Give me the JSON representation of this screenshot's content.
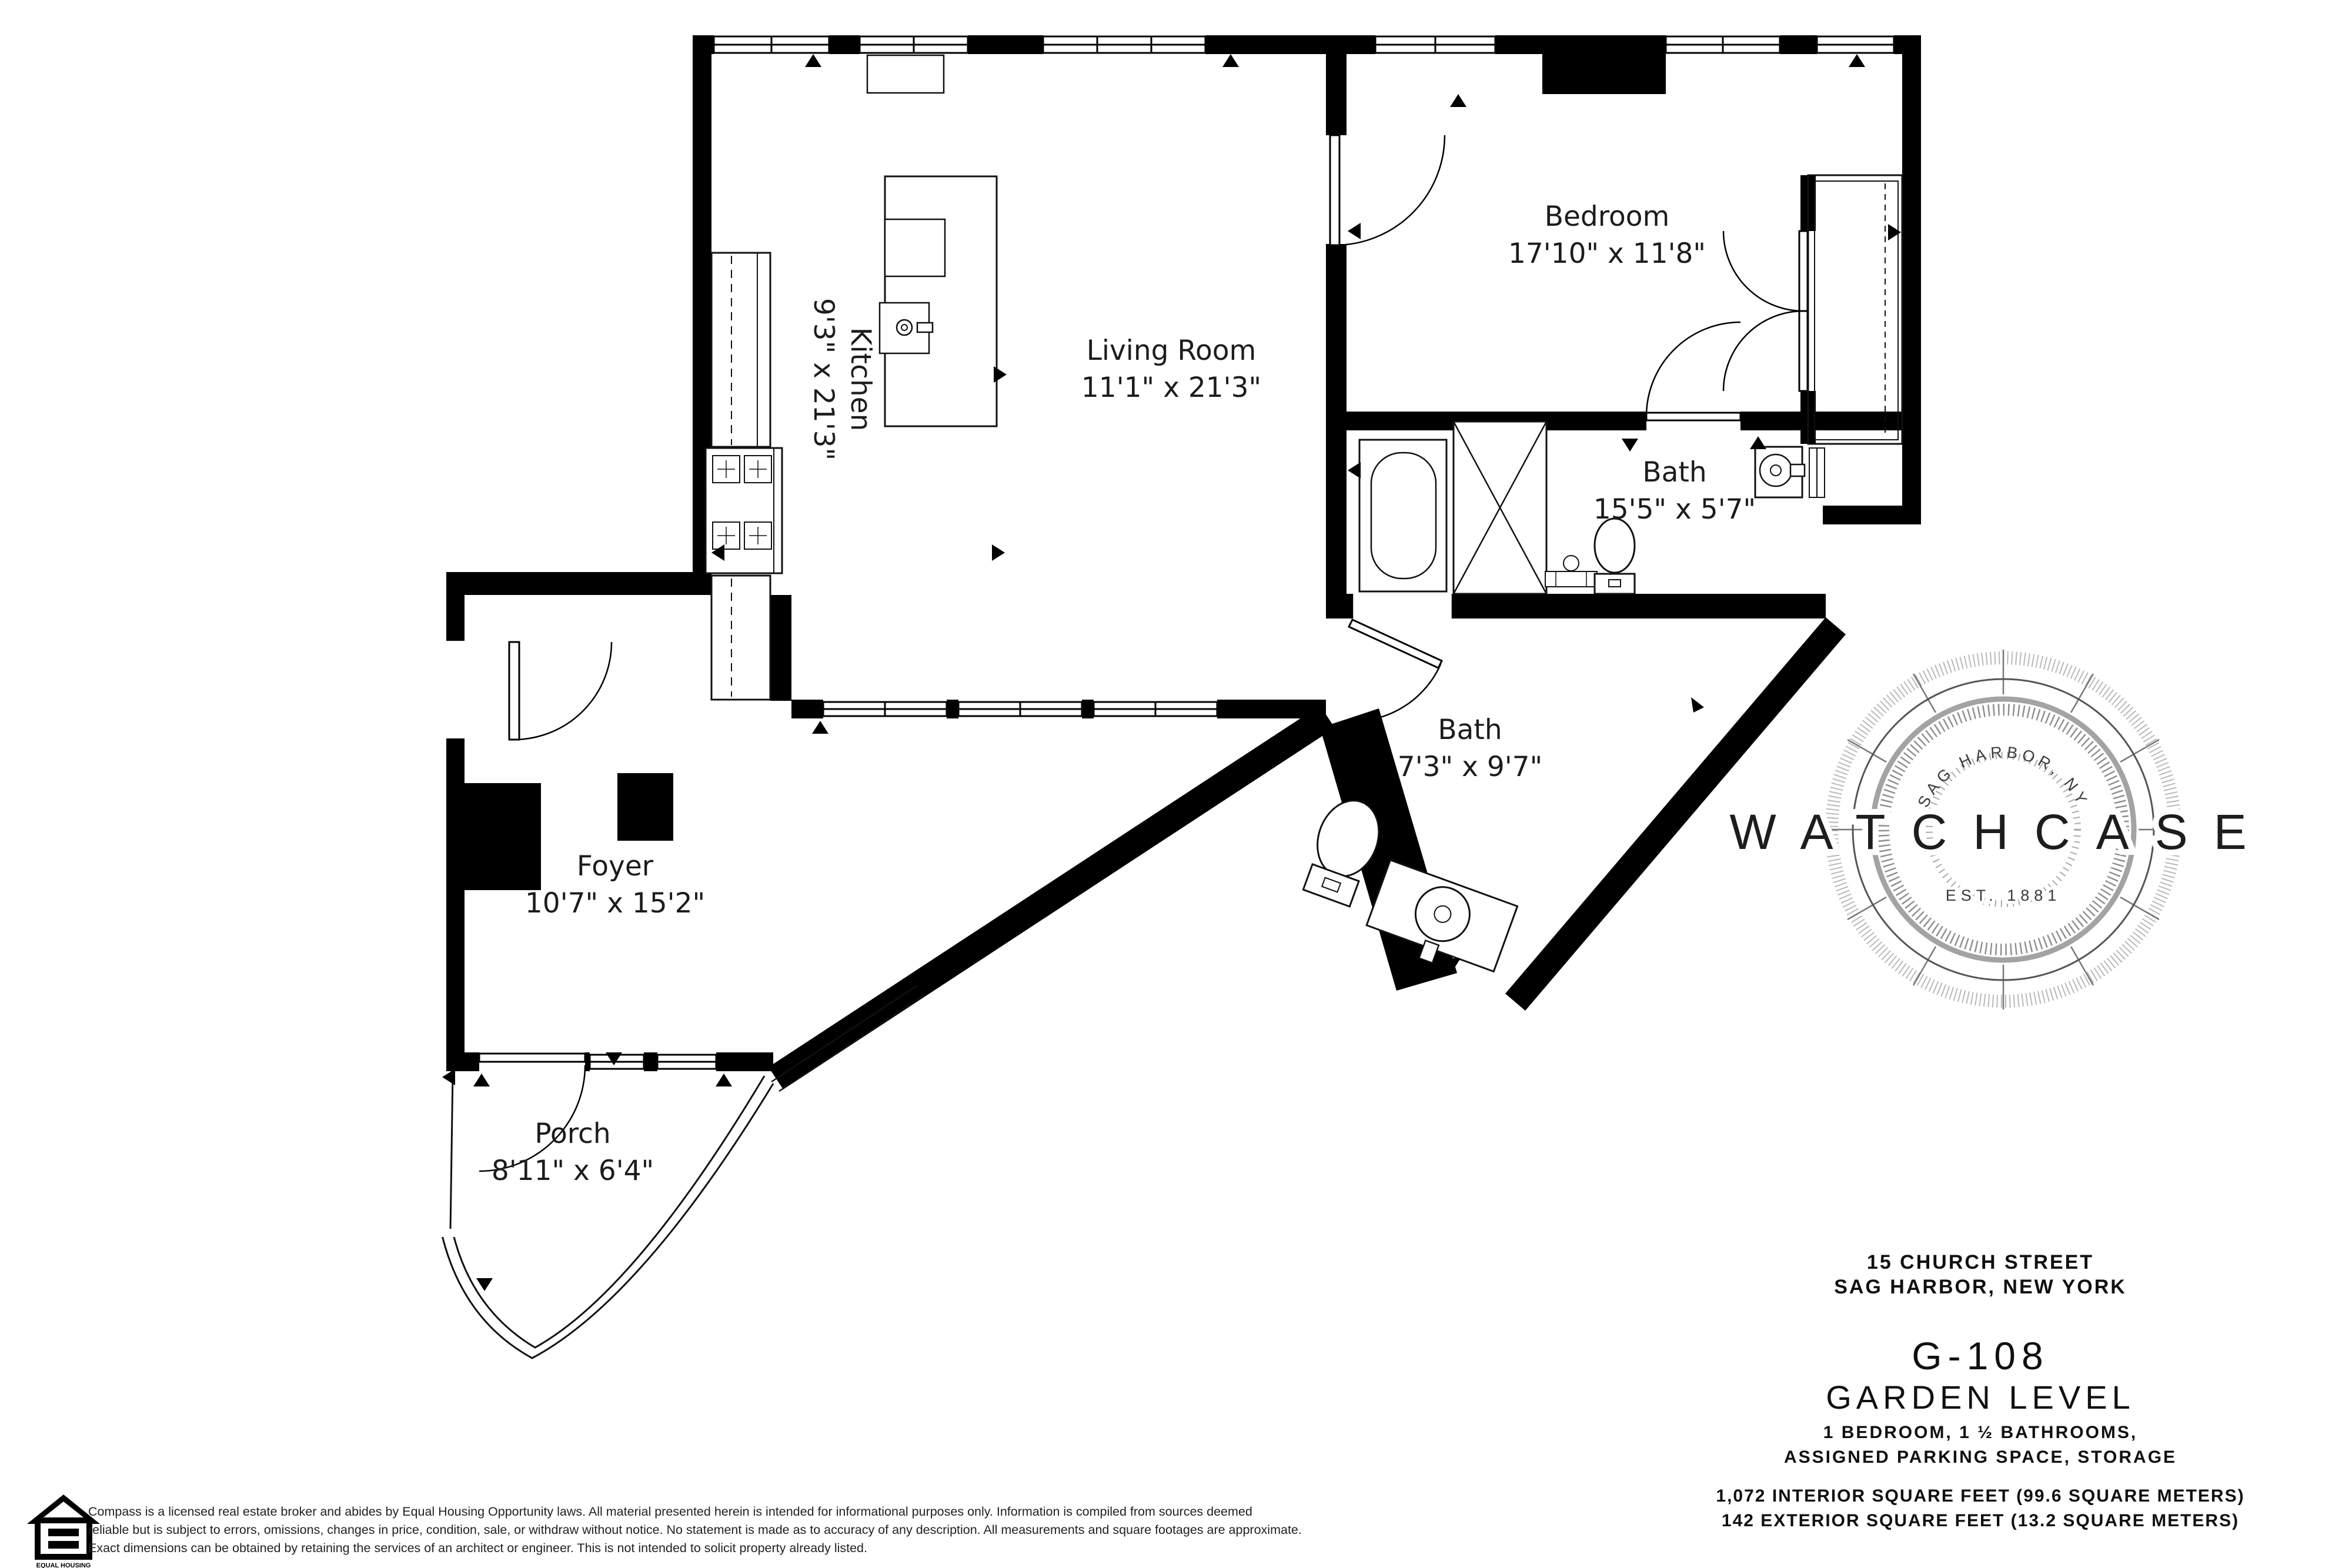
{
  "plan": {
    "rooms": [
      {
        "name": "Kitchen",
        "dims": "9'3\" x 21'3\""
      },
      {
        "name": "Living Room",
        "dims": "11'1\" x 21'3\""
      },
      {
        "name": "Bedroom",
        "dims": "17'10\" x 11'8\""
      },
      {
        "name": "Bath",
        "dims": "15'5\" x 5'7\""
      },
      {
        "name": "Bath",
        "dims": "7'3\" x 9'7\""
      },
      {
        "name": "Foyer",
        "dims": "10'7\" x 15'2\""
      },
      {
        "name": "Porch",
        "dims": "8'11\" x 6'4\""
      }
    ]
  },
  "logo": {
    "brand": "WATCHCASE",
    "seal_arc_text": "SAG HARBOR, NY",
    "seal_est_text": "EST. 1881"
  },
  "title_block": {
    "address_line1": "15 CHURCH STREET",
    "address_line2": "SAG HARBOR, NEW YORK",
    "unit": "G-108",
    "level": "GARDEN LEVEL",
    "features_line1": "1 BEDROOM, 1 ½ BATHROOMS,",
    "features_line2": "ASSIGNED PARKING SPACE, STORAGE",
    "area_line1": "1,072 INTERIOR SQUARE FEET (99.6 SQUARE METERS)",
    "area_line2": "142 EXTERIOR SQUARE FEET (13.2 SQUARE METERS)"
  },
  "footer": {
    "disclaimer_line1": "Compass is a licensed real estate broker and abides by Equal Housing Opportunity laws. All material presented herein is intended for informational purposes only. Information is compiled from sources deemed",
    "disclaimer_line2": "reliable but is subject to errors, omissions, changes in price, condition, sale, or withdra​w without notice. No statement is made as to accuracy of any description. All measurements and square footages are approximate.",
    "disclaimer_line3": "Exact dimensions can be obtained by retaining the services of an architect or engineer. This is not intended to solicit property already listed.",
    "eho_line1": "EQUAL HOUSING",
    "eho_line2": "OPPORTUNITY"
  },
  "colors": {
    "wall": "#000000",
    "background": "#ffffff",
    "seal_gray": "#a3a3a3",
    "text": "#1c1c1c"
  }
}
